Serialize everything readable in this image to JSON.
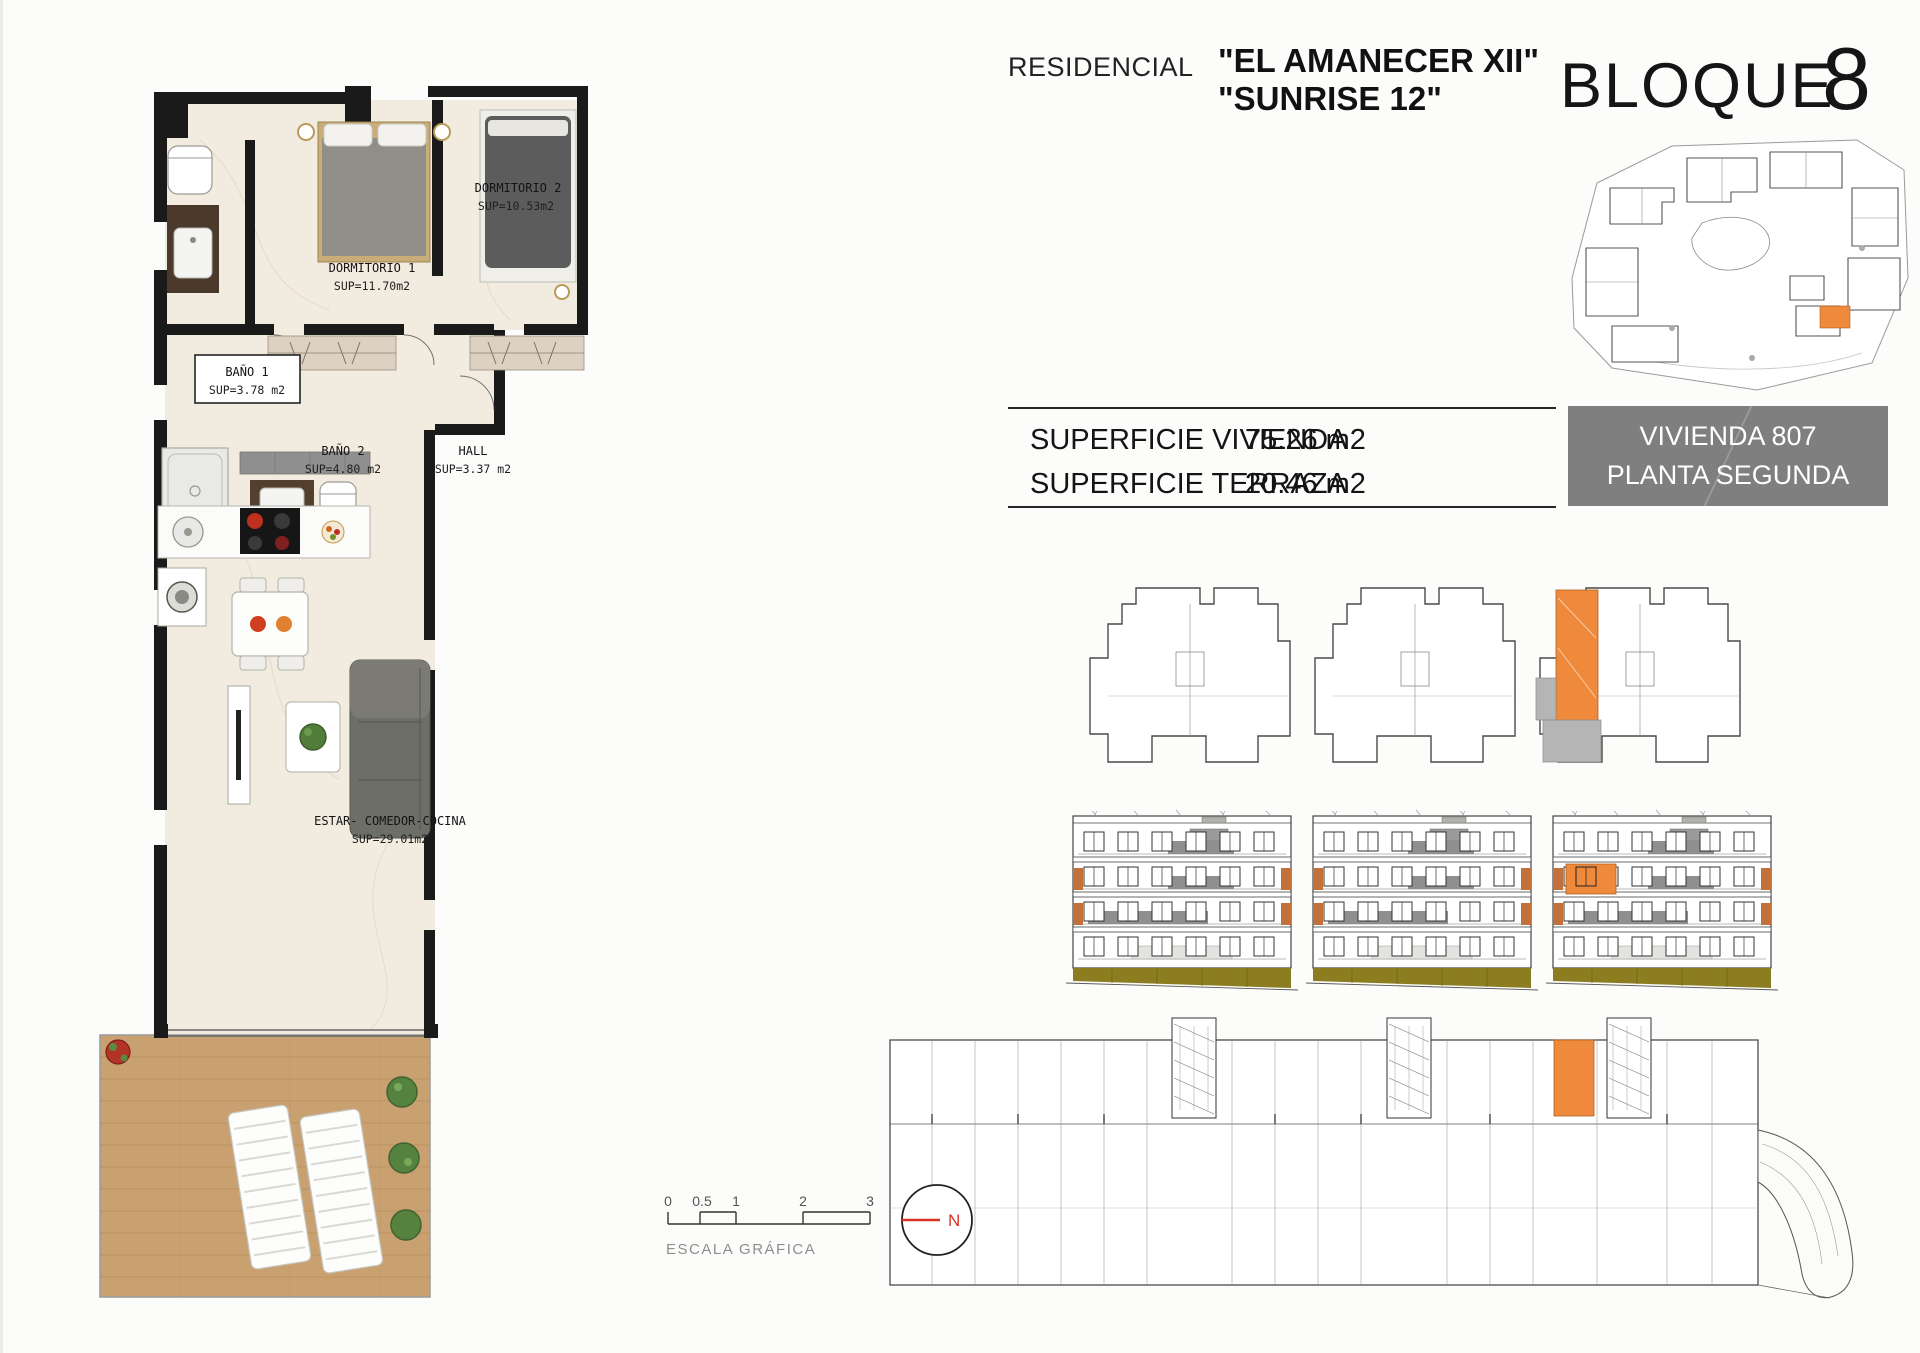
{
  "header": {
    "residencial": "RESIDENCIAL",
    "name_line1": "\"EL AMANECER XII\"",
    "name_line2": "\"SUNRISE 12\"",
    "bloque_label": "BLOQUE",
    "bloque_number": "8"
  },
  "info_table": {
    "rows": [
      {
        "label": "SUPERFICIE VIVIENDA",
        "value": "75.26 m2"
      },
      {
        "label": "SUPERFICIE TERRAZA",
        "value": "20.46 m2"
      }
    ],
    "unit_box": {
      "line1": "VIVIENDA 807",
      "line2": "PLANTA SEGUNDA"
    }
  },
  "floorplan": {
    "rooms": [
      {
        "name": "DORMITORIO 1",
        "area": "SUP=11.70m2"
      },
      {
        "name": "DORMITORIO 2",
        "area": "SUP=10.53m2"
      },
      {
        "name": "BAÑO 1",
        "area": "SUP=3.78 m2"
      },
      {
        "name": "BAÑO 2",
        "area": "SUP=4.80 m2"
      },
      {
        "name": "HALL",
        "area": "SUP=3.37 m2"
      },
      {
        "name": "ESTAR- COMEDOR-COCINA",
        "area": "SUP=29.01m2"
      }
    ]
  },
  "scale_bar": {
    "ticks": [
      "0",
      "0.5",
      "1",
      "2",
      "3"
    ],
    "label": "ESCALA GRÁFICA"
  },
  "compass": {
    "north": "N"
  },
  "colors": {
    "highlight": "#ef8a3d",
    "accent_orange": "#c4703a",
    "unit_box_gray": "#7f7f7f",
    "balcony_gray": "#8f8f8f",
    "ground_olive": "#8b7d20",
    "north_red": "#d93425"
  }
}
